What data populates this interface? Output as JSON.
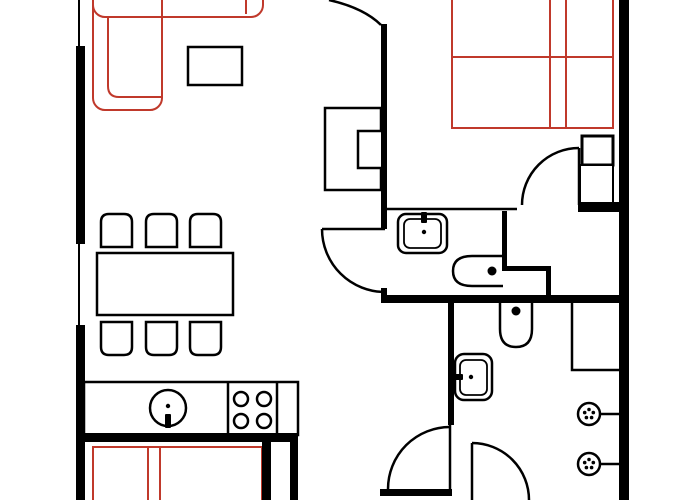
{
  "canvas": {
    "width": 700,
    "height": 500,
    "background": "#ffffff"
  },
  "palette": {
    "black": "#000000",
    "soft": "#c0392b",
    "white": "#ffffff",
    "none": "none"
  },
  "legend": {
    "wall_color": "#000000",
    "soft_furniture_color": "#c0392b"
  },
  "elements": [
    {
      "name": "sofa-long-section",
      "shape": "rect",
      "x": 93,
      "y": -28,
      "w": 170,
      "h": 45,
      "rx": 12,
      "stroke": "soft",
      "sw": 2,
      "fill": "none"
    },
    {
      "name": "sofa-armrest-line",
      "shape": "line",
      "x1": 246,
      "y1": 0,
      "x2": 246,
      "y2": 14,
      "stroke": "soft",
      "sw": 2
    },
    {
      "name": "sofa-chaise-section",
      "shape": "rect",
      "x": 93,
      "y": -28,
      "w": 69,
      "h": 138,
      "rx": 12,
      "stroke": "soft",
      "sw": 2,
      "fill": "none"
    },
    {
      "name": "sofa-seat-inner-line",
      "shape": "path",
      "d": "M 108 16 V 86 Q 108 97 119 97 H 161",
      "stroke": "soft",
      "sw": 2,
      "fill": "none"
    },
    {
      "name": "double-bed-outline",
      "shape": "path",
      "d": "M 452 -5 V 128 H 613 V -5",
      "stroke": "soft",
      "sw": 2,
      "fill": "none"
    },
    {
      "name": "double-bed-blanket-line",
      "shape": "line",
      "x1": 452,
      "y1": 57,
      "x2": 613,
      "y2": 57,
      "stroke": "soft",
      "sw": 2
    },
    {
      "name": "double-bed-divider-line-1",
      "shape": "line",
      "x1": 550,
      "y1": -5,
      "x2": 550,
      "y2": 128,
      "stroke": "soft",
      "sw": 2
    },
    {
      "name": "double-bed-divider-line-2",
      "shape": "line",
      "x1": 566,
      "y1": -5,
      "x2": 566,
      "y2": 128,
      "stroke": "soft",
      "sw": 2
    },
    {
      "name": "second-bed-outline",
      "shape": "path",
      "d": "M 93 502 V 447 H 262 V 502",
      "stroke": "soft",
      "sw": 2,
      "fill": "none"
    },
    {
      "name": "second-bed-headboard-line-1",
      "shape": "line",
      "x1": 148,
      "y1": 447,
      "x2": 148,
      "y2": 500,
      "stroke": "soft",
      "sw": 2
    },
    {
      "name": "second-bed-headboard-line-2",
      "shape": "line",
      "x1": 160,
      "y1": 447,
      "x2": 160,
      "y2": 500,
      "stroke": "soft",
      "sw": 2
    },
    {
      "name": "coffee-table",
      "shape": "rect",
      "x": 188,
      "y": 47,
      "w": 54,
      "h": 38,
      "rx": 0,
      "stroke": "black",
      "sw": 2.5,
      "fill": "white"
    },
    {
      "name": "wall-unit",
      "shape": "path",
      "d": "M 325 108 H 381 V 131 H 358 V 168 H 381 V 190 H 325 Z",
      "stroke": "black",
      "sw": 2.5,
      "fill": "white"
    },
    {
      "name": "dining-table",
      "shape": "rect",
      "x": 97,
      "y": 253,
      "w": 136,
      "h": 62,
      "rx": 0,
      "stroke": "black",
      "sw": 2.5,
      "fill": "white"
    },
    {
      "name": "chair-top-1",
      "shape": "path",
      "d": "M 101 247 V 222 Q 101 214 109 214 H 124 Q 132 214 132 222 V 247 Z",
      "stroke": "black",
      "sw": 2.5,
      "fill": "white"
    },
    {
      "name": "chair-top-2",
      "shape": "path",
      "d": "M 146 247 V 222 Q 146 214 154 214 H 169 Q 177 214 177 222 V 247 Z",
      "stroke": "black",
      "sw": 2.5,
      "fill": "white"
    },
    {
      "name": "chair-top-3",
      "shape": "path",
      "d": "M 190 247 V 222 Q 190 214 198 214 H 213 Q 221 214 221 222 V 247 Z",
      "stroke": "black",
      "sw": 2.5,
      "fill": "white"
    },
    {
      "name": "chair-bottom-1",
      "shape": "path",
      "d": "M 101 322 V 347 Q 101 355 109 355 H 124 Q 132 355 132 347 V 322 Z",
      "stroke": "black",
      "sw": 2.5,
      "fill": "white"
    },
    {
      "name": "chair-bottom-2",
      "shape": "path",
      "d": "M 146 322 V 347 Q 146 355 154 355 H 169 Q 177 355 177 347 V 322 Z",
      "stroke": "black",
      "sw": 2.5,
      "fill": "white"
    },
    {
      "name": "chair-bottom-3",
      "shape": "path",
      "d": "M 190 322 V 347 Q 190 355 198 355 H 213 Q 221 355 221 347 V 322 Z",
      "stroke": "black",
      "sw": 2.5,
      "fill": "white"
    },
    {
      "name": "kitchen-counter",
      "shape": "rect",
      "x": 84,
      "y": 382,
      "w": 214,
      "h": 53,
      "rx": 0,
      "stroke": "black",
      "sw": 2.5,
      "fill": "white"
    },
    {
      "name": "kitchen-divider-1",
      "shape": "line",
      "x1": 228,
      "y1": 382,
      "x2": 228,
      "y2": 435,
      "stroke": "black",
      "sw": 2.5
    },
    {
      "name": "kitchen-divider-2",
      "shape": "line",
      "x1": 277,
      "y1": 382,
      "x2": 277,
      "y2": 435,
      "stroke": "black",
      "sw": 2.5
    },
    {
      "name": "kitchen-sink-basin",
      "shape": "circle",
      "cx": 168,
      "cy": 408,
      "r": 18,
      "stroke": "black",
      "sw": 2.5,
      "fill": "white"
    },
    {
      "name": "kitchen-sink-faucet",
      "shape": "rect",
      "x": 165,
      "y": 414,
      "w": 6,
      "h": 14,
      "rx": 1,
      "stroke": "none",
      "sw": 0,
      "fill": "black"
    },
    {
      "name": "kitchen-sink-dot",
      "shape": "circle",
      "cx": 168,
      "cy": 406,
      "r": 2.2,
      "stroke": "none",
      "sw": 0,
      "fill": "black"
    },
    {
      "name": "stove-burner-1",
      "shape": "circle",
      "cx": 241,
      "cy": 399,
      "r": 7,
      "stroke": "black",
      "sw": 2.5,
      "fill": "white"
    },
    {
      "name": "stove-burner-2",
      "shape": "circle",
      "cx": 264,
      "cy": 399,
      "r": 7,
      "stroke": "black",
      "sw": 2.5,
      "fill": "white"
    },
    {
      "name": "stove-burner-3",
      "shape": "circle",
      "cx": 241,
      "cy": 421,
      "r": 7,
      "stroke": "black",
      "sw": 2.5,
      "fill": "white"
    },
    {
      "name": "stove-burner-4",
      "shape": "circle",
      "cx": 264,
      "cy": 421,
      "r": 7,
      "stroke": "black",
      "sw": 2.5,
      "fill": "white"
    },
    {
      "name": "nightstand",
      "shape": "rect",
      "x": 582,
      "y": 136,
      "w": 31,
      "h": 29,
      "rx": 0,
      "stroke": "black",
      "sw": 3,
      "fill": "white"
    },
    {
      "name": "closet-column",
      "shape": "rect",
      "x": 580,
      "y": 165,
      "w": 33,
      "h": 39,
      "rx": 0,
      "stroke": "black",
      "sw": 2,
      "fill": "white"
    },
    {
      "name": "bathroom-sink-outer",
      "shape": "rect",
      "x": 398,
      "y": 214,
      "w": 49,
      "h": 39,
      "rx": 8,
      "stroke": "black",
      "sw": 2.5,
      "fill": "white"
    },
    {
      "name": "bathroom-sink-inner",
      "shape": "rect",
      "x": 404,
      "y": 219,
      "w": 37,
      "h": 29,
      "rx": 6,
      "stroke": "black",
      "sw": 1.8,
      "fill": "none"
    },
    {
      "name": "bathroom-sink-faucet",
      "shape": "rect",
      "x": 421,
      "y": 212,
      "w": 6,
      "h": 11,
      "rx": 1,
      "stroke": "none",
      "sw": 0,
      "fill": "black"
    },
    {
      "name": "bathroom-sink-dot",
      "shape": "circle",
      "cx": 424,
      "cy": 232,
      "r": 2.2,
      "stroke": "none",
      "sw": 0,
      "fill": "black"
    },
    {
      "name": "bathroom-toilet",
      "shape": "path",
      "d": "M 503 256 H 472 Q 453 256 453 271 Q 453 286 472 286 H 503",
      "stroke": "black",
      "sw": 2.5,
      "fill": "white"
    },
    {
      "name": "bathroom-toilet-dot",
      "shape": "circle",
      "cx": 492,
      "cy": 271,
      "r": 4.5,
      "stroke": "none",
      "sw": 0,
      "fill": "black"
    },
    {
      "name": "wc-toilet",
      "shape": "path",
      "d": "M 500 302 V 329 Q 500 347 516 347 Q 532 347 532 329 V 302",
      "stroke": "black",
      "sw": 2.5,
      "fill": "white"
    },
    {
      "name": "wc-toilet-dot",
      "shape": "circle",
      "cx": 516,
      "cy": 311,
      "r": 4.5,
      "stroke": "none",
      "sw": 0,
      "fill": "black"
    },
    {
      "name": "wc-sink-outer",
      "shape": "rect",
      "x": 455,
      "y": 354,
      "w": 37,
      "h": 46,
      "rx": 9,
      "stroke": "black",
      "sw": 2.5,
      "fill": "white"
    },
    {
      "name": "wc-sink-inner",
      "shape": "rect",
      "x": 460,
      "y": 360,
      "w": 27,
      "h": 35,
      "rx": 6,
      "stroke": "black",
      "sw": 1.8,
      "fill": "none"
    },
    {
      "name": "wc-sink-faucet",
      "shape": "rect",
      "x": 453,
      "y": 374,
      "w": 10,
      "h": 6,
      "rx": 1,
      "stroke": "none",
      "sw": 0,
      "fill": "black"
    },
    {
      "name": "wc-sink-dot",
      "shape": "circle",
      "cx": 471,
      "cy": 377,
      "r": 2.2,
      "stroke": "none",
      "sw": 0,
      "fill": "black"
    },
    {
      "name": "wc-shower-closet",
      "shape": "path",
      "d": "M 572 303 V 370 H 619",
      "stroke": "black",
      "sw": 2.5,
      "fill": "none"
    },
    {
      "name": "radiator-valve-1",
      "shape": "circle",
      "cx": 589,
      "cy": 414,
      "r": 11,
      "stroke": "black",
      "sw": 2.5,
      "fill": "white"
    },
    {
      "name": "radiator-valve-1-dot-a",
      "shape": "circle",
      "cx": 589,
      "cy": 409.5,
      "r": 1.8,
      "stroke": "none",
      "sw": 0,
      "fill": "black"
    },
    {
      "name": "radiator-valve-1-dot-b",
      "shape": "circle",
      "cx": 593.3,
      "cy": 412.6,
      "r": 1.8,
      "stroke": "none",
      "sw": 0,
      "fill": "black"
    },
    {
      "name": "radiator-valve-1-dot-c",
      "shape": "circle",
      "cx": 591.6,
      "cy": 417.6,
      "r": 1.8,
      "stroke": "none",
      "sw": 0,
      "fill": "black"
    },
    {
      "name": "radiator-valve-1-dot-d",
      "shape": "circle",
      "cx": 586.4,
      "cy": 417.6,
      "r": 1.8,
      "stroke": "none",
      "sw": 0,
      "fill": "black"
    },
    {
      "name": "radiator-valve-1-dot-e",
      "shape": "circle",
      "cx": 584.7,
      "cy": 412.6,
      "r": 1.8,
      "stroke": "none",
      "sw": 0,
      "fill": "black"
    },
    {
      "name": "radiator-stub-1",
      "shape": "line",
      "x1": 600,
      "y1": 414,
      "x2": 619,
      "y2": 414,
      "stroke": "black",
      "sw": 2.5
    },
    {
      "name": "radiator-valve-2",
      "shape": "circle",
      "cx": 589,
      "cy": 464,
      "r": 11,
      "stroke": "black",
      "sw": 2.5,
      "fill": "white"
    },
    {
      "name": "radiator-valve-2-dot-a",
      "shape": "circle",
      "cx": 589,
      "cy": 459.5,
      "r": 1.8,
      "stroke": "none",
      "sw": 0,
      "fill": "black"
    },
    {
      "name": "radiator-valve-2-dot-b",
      "shape": "circle",
      "cx": 593.3,
      "cy": 462.6,
      "r": 1.8,
      "stroke": "none",
      "sw": 0,
      "fill": "black"
    },
    {
      "name": "radiator-valve-2-dot-c",
      "shape": "circle",
      "cx": 591.6,
      "cy": 467.6,
      "r": 1.8,
      "stroke": "none",
      "sw": 0,
      "fill": "black"
    },
    {
      "name": "radiator-valve-2-dot-d",
      "shape": "circle",
      "cx": 586.4,
      "cy": 467.6,
      "r": 1.8,
      "stroke": "none",
      "sw": 0,
      "fill": "black"
    },
    {
      "name": "radiator-valve-2-dot-e",
      "shape": "circle",
      "cx": 584.7,
      "cy": 462.6,
      "r": 1.8,
      "stroke": "none",
      "sw": 0,
      "fill": "black"
    },
    {
      "name": "radiator-stub-2",
      "shape": "line",
      "x1": 600,
      "y1": 464,
      "x2": 619,
      "y2": 464,
      "stroke": "black",
      "sw": 2.5
    },
    {
      "name": "wall-left-upper",
      "shape": "rect",
      "x": 76,
      "y": 46,
      "w": 9,
      "h": 198,
      "rx": 0,
      "stroke": "none",
      "sw": 0,
      "fill": "black"
    },
    {
      "name": "wall-left-lower",
      "shape": "rect",
      "x": 76,
      "y": 325,
      "w": 9,
      "h": 175,
      "rx": 0,
      "stroke": "none",
      "sw": 0,
      "fill": "black"
    },
    {
      "name": "wall-right",
      "shape": "rect",
      "x": 619,
      "y": 0,
      "w": 10,
      "h": 500,
      "rx": 0,
      "stroke": "none",
      "sw": 0,
      "fill": "black"
    },
    {
      "name": "wall-living-bedroom",
      "shape": "rect",
      "x": 381,
      "y": 24,
      "w": 6,
      "h": 205,
      "rx": 0,
      "stroke": "none",
      "sw": 0,
      "fill": "black"
    },
    {
      "name": "wall-living-bedroom-stub",
      "shape": "rect",
      "x": 381,
      "y": 288,
      "w": 6,
      "h": 10,
      "rx": 0,
      "stroke": "none",
      "sw": 0,
      "fill": "black"
    },
    {
      "name": "wall-main-horizontal",
      "shape": "rect",
      "x": 381,
      "y": 295,
      "w": 248,
      "h": 8,
      "rx": 0,
      "stroke": "none",
      "sw": 0,
      "fill": "black"
    },
    {
      "name": "wall-bedroom-bottom",
      "shape": "rect",
      "x": 578,
      "y": 202,
      "w": 50,
      "h": 10,
      "rx": 0,
      "stroke": "none",
      "sw": 0,
      "fill": "black"
    },
    {
      "name": "wall-vestibule-vertical-1",
      "shape": "rect",
      "x": 502,
      "y": 211,
      "w": 5,
      "h": 60,
      "rx": 0,
      "stroke": "none",
      "sw": 0,
      "fill": "black"
    },
    {
      "name": "wall-vestibule-horizontal",
      "shape": "rect",
      "x": 502,
      "y": 266,
      "w": 49,
      "h": 5,
      "rx": 0,
      "stroke": "none",
      "sw": 0,
      "fill": "black"
    },
    {
      "name": "wall-vestibule-vertical-2",
      "shape": "rect",
      "x": 546,
      "y": 271,
      "w": 5,
      "h": 26,
      "rx": 0,
      "stroke": "none",
      "sw": 0,
      "fill": "black"
    },
    {
      "name": "wall-wc-left",
      "shape": "rect",
      "x": 448,
      "y": 303,
      "w": 6,
      "h": 122,
      "rx": 0,
      "stroke": "none",
      "sw": 0,
      "fill": "black"
    },
    {
      "name": "wall-kitchen-bottom",
      "shape": "rect",
      "x": 78,
      "y": 433,
      "w": 220,
      "h": 9,
      "rx": 0,
      "stroke": "none",
      "sw": 0,
      "fill": "black"
    },
    {
      "name": "wall-bedroom2-right",
      "shape": "rect",
      "x": 262,
      "y": 442,
      "w": 9,
      "h": 58,
      "rx": 0,
      "stroke": "none",
      "sw": 0,
      "fill": "black"
    },
    {
      "name": "wall-hallway-left",
      "shape": "rect",
      "x": 290,
      "y": 442,
      "w": 8,
      "h": 58,
      "rx": 0,
      "stroke": "none",
      "sw": 0,
      "fill": "black"
    },
    {
      "name": "wall-hallway-bottom",
      "shape": "rect",
      "x": 380,
      "y": 489,
      "w": 72,
      "h": 7,
      "rx": 0,
      "stroke": "none",
      "sw": 0,
      "fill": "black"
    },
    {
      "name": "window-left-top",
      "shape": "line",
      "x1": 79,
      "y1": 0,
      "x2": 79,
      "y2": 46,
      "stroke": "black",
      "sw": 2
    },
    {
      "name": "window-left-middle",
      "shape": "line",
      "x1": 79,
      "y1": 244,
      "x2": 79,
      "y2": 325,
      "stroke": "black",
      "sw": 2
    },
    {
      "name": "wall-bathroom-top-thin",
      "shape": "line",
      "x1": 385,
      "y1": 209,
      "x2": 517,
      "y2": 209,
      "stroke": "black",
      "sw": 2.5
    },
    {
      "name": "door-top-arc",
      "shape": "path",
      "d": "M 329 0 Q 364 8 381 25",
      "stroke": "black",
      "sw": 2.5,
      "fill": "none"
    },
    {
      "name": "door-bathroom-leaf",
      "shape": "line",
      "x1": 322,
      "y1": 229,
      "x2": 385,
      "y2": 229,
      "stroke": "black",
      "sw": 2.5
    },
    {
      "name": "door-bathroom-arc",
      "shape": "path",
      "d": "M 322 229 A 63 63 0 0 0 385 292",
      "stroke": "black",
      "sw": 2.5,
      "fill": "none"
    },
    {
      "name": "door-bedroom-leaf",
      "shape": "line",
      "x1": 579,
      "y1": 148,
      "x2": 579,
      "y2": 205,
      "stroke": "black",
      "sw": 2.5
    },
    {
      "name": "door-bedroom-arc",
      "shape": "path",
      "d": "M 522 205 A 57 57 0 0 1 579 148",
      "stroke": "black",
      "sw": 2.5,
      "fill": "none"
    },
    {
      "name": "door-hallway-leaf",
      "shape": "line",
      "x1": 450,
      "y1": 424,
      "x2": 450,
      "y2": 489,
      "stroke": "black",
      "sw": 2.5
    },
    {
      "name": "door-hallway-arc",
      "shape": "path",
      "d": "M 450 427 A 62 62 0 0 0 388 489",
      "stroke": "black",
      "sw": 2.5,
      "fill": "none"
    },
    {
      "name": "door-wc-leaf",
      "shape": "line",
      "x1": 472,
      "y1": 443,
      "x2": 472,
      "y2": 500,
      "stroke": "black",
      "sw": 2.5
    },
    {
      "name": "door-wc-arc",
      "shape": "path",
      "d": "M 472 443 A 57 57 0 0 1 529 500",
      "stroke": "black",
      "sw": 2.5,
      "fill": "none"
    }
  ]
}
